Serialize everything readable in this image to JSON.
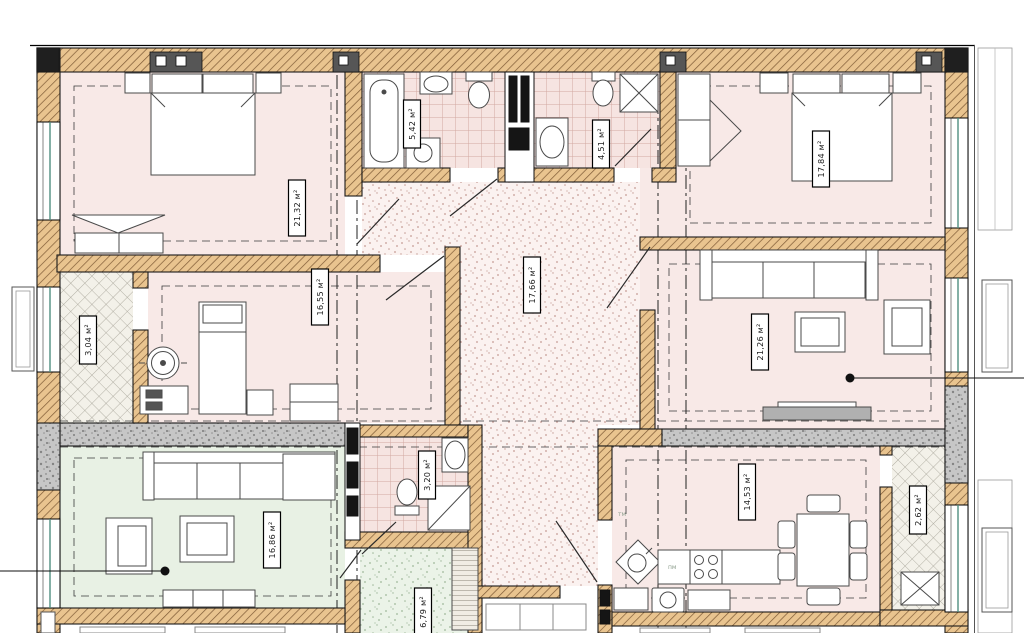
{
  "title": "apartment-floor-plan",
  "rooms": [
    {
      "name": "bedroom-1",
      "area_label": "21,32 м²"
    },
    {
      "name": "bedroom-3",
      "area_label": "16,55 м²"
    },
    {
      "name": "hallway-main",
      "area_label": "17,66 м²"
    },
    {
      "name": "bathroom-1",
      "area_label": "5,42 м²"
    },
    {
      "name": "bathroom-2",
      "area_label": "4,51 м²"
    },
    {
      "name": "bedroom-2",
      "area_label": "17,84 м²"
    },
    {
      "name": "living-room",
      "area_label": "21,26 м²"
    },
    {
      "name": "kitchen-dining",
      "area_label": "14,53 м²"
    },
    {
      "name": "living-room-2",
      "area_label": "16,86 м²"
    },
    {
      "name": "bathroom-3",
      "area_label": "3,20 м²"
    },
    {
      "name": "hallway-2",
      "area_label": "6,79 м²"
    },
    {
      "name": "pantry",
      "area_label": "3,04 м²"
    },
    {
      "name": "closet",
      "area_label": "2,62 м²"
    }
  ],
  "annotations": {
    "appliance_label_1": "тм",
    "appliance_label_2": "пм"
  },
  "colors": {
    "room_pink": "#f8e9e7",
    "room_green": "#e8f1e4",
    "wall_tan": "#e9c48f",
    "tile_pink": "#f6e4e1",
    "window_glass": "#4f8f7f"
  }
}
